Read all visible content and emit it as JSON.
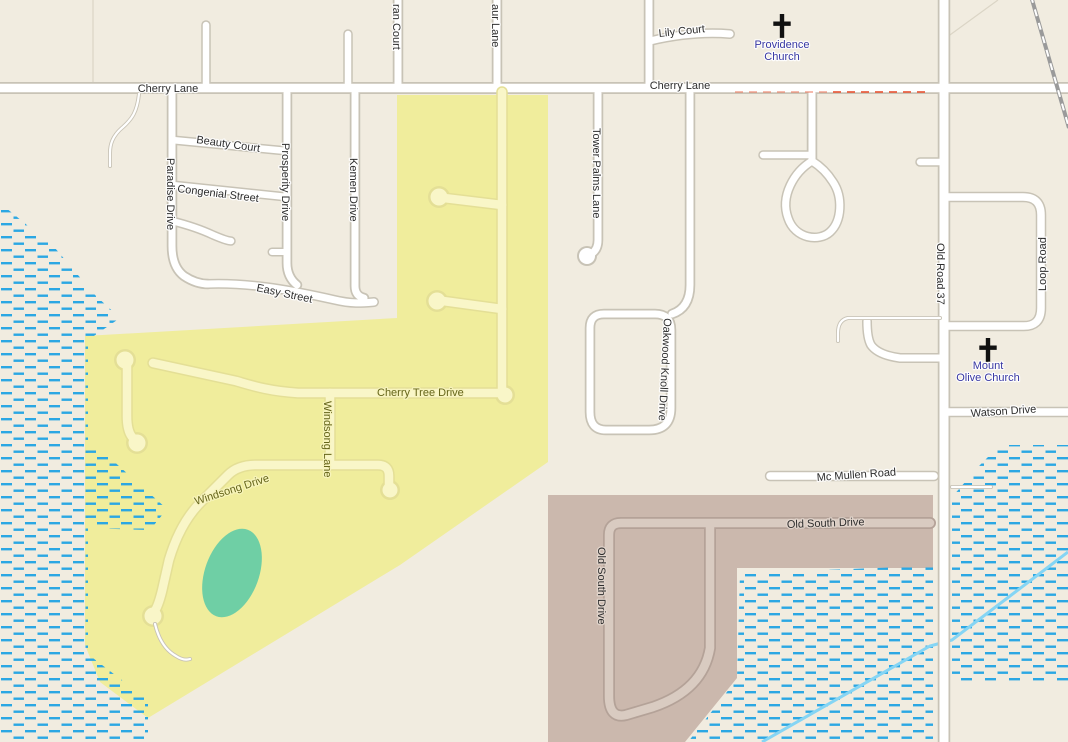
{
  "map": {
    "streets": {
      "cherry_lane_west": "Cherry Lane",
      "cherry_lane_east": "Cherry Lane",
      "ran_court": "ran Court",
      "aur_lane": "aur Lane",
      "lily_court": "Lily Court",
      "beauty_court": "Beauty Court",
      "congenial_street": "Congenial Street",
      "paradise_drive": "Paradise Drive",
      "prosperity_drive": "Prosperity Drive",
      "kemen_drive": "Kemen Drive",
      "easy_street": "Easy Street",
      "tower_palms_lane": "Tower Palms Lane",
      "oakwood_knoll_drive": "Oakwood Knoll Drive",
      "cherry_tree_drive": "Cherry Tree Drive",
      "windsong_lane": "Windsong Lane",
      "windsong_drive": "Windsong Drive",
      "mc_mullen_road": "Mc Mullen Road",
      "old_south_drive_horizontal": "Old South Drive",
      "old_south_drive_vertical": "Old South Drive",
      "watson_drive": "Watson Drive",
      "old_road_37": "Old Road 37",
      "loop_road": "Loop Road"
    },
    "pois": {
      "providence_church": {
        "line1": "Providence",
        "line2": "Church"
      },
      "mount_olive_church": {
        "line1": "Mount",
        "line2": "Olive Church"
      }
    },
    "colors": {
      "background": "#F1ECE0",
      "road_fill": "#FFFFFF",
      "road_casing": "#C8C3B6",
      "label": "#2E2E2E",
      "golf_area": "#F0ED9C",
      "golf_area_edge": "#E3DF8E",
      "golf_road": "#F9F6C8",
      "golf_road_casing": "#E4DF96",
      "golf_label": "#65651A",
      "residential_brown": "#CBB8AD",
      "brown_road": "#D9CBC1",
      "brown_road_casing": "#B4A298",
      "green_area": "#6FCFA5",
      "marsh": "#2BA7E3",
      "stream": "#85D5F4",
      "church_label": "#3737A3",
      "church_symbol": "#111111",
      "railway": "#9A9A9A",
      "barrier_red": "#E8502F",
      "block_outline": "#DBD5C6"
    }
  }
}
